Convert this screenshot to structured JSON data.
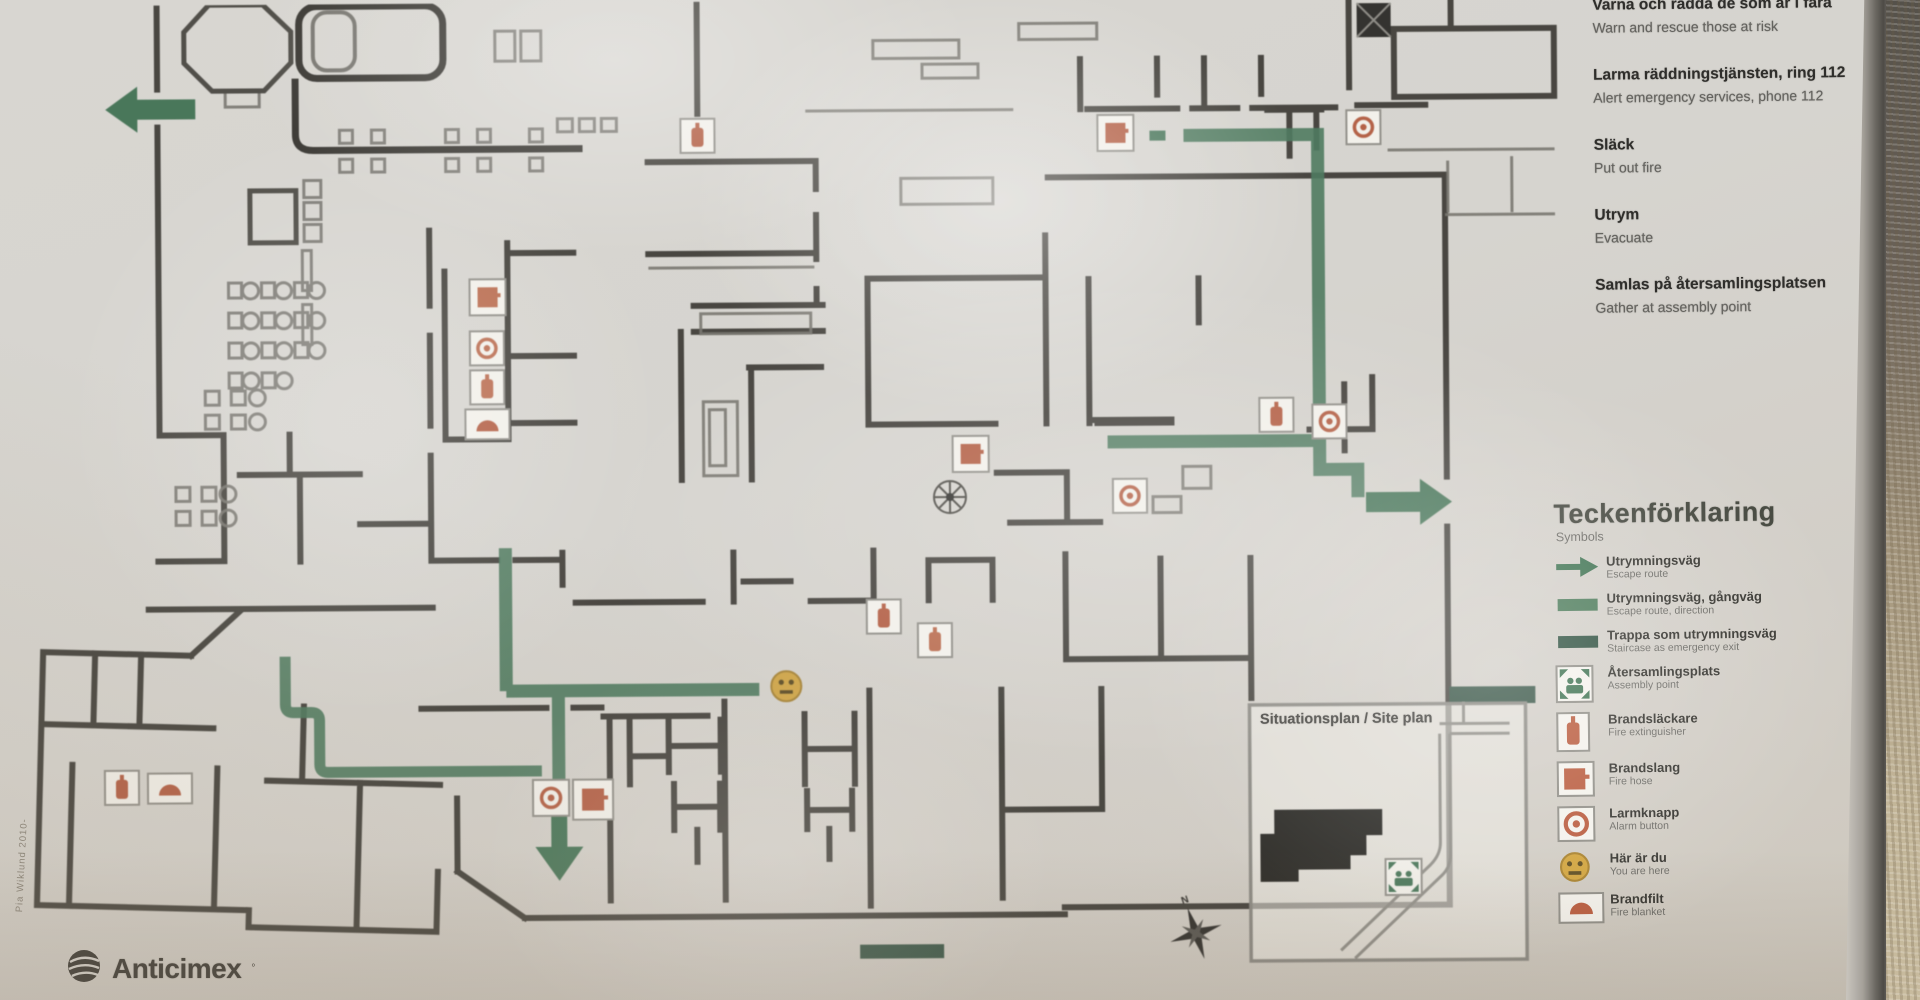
{
  "sign": {
    "instructions": [
      {
        "sv": "Varna och rädda de som är i fara",
        "en": "Warn and rescue those at risk"
      },
      {
        "sv": "Larma räddningstjänsten, ring 112",
        "en": "Alert emergency services, phone 112"
      },
      {
        "sv": "Släck",
        "en": "Put out fire"
      },
      {
        "sv": "Utrym",
        "en": "Evacuate"
      },
      {
        "sv": "Samlas på återsamlingsplatsen",
        "en": "Gather at assembly point"
      }
    ],
    "legend": {
      "title": "Teckenförklaring",
      "subtitle": "Symbols",
      "items": [
        {
          "icon": "escape-route-arrow-icon",
          "sv": "Utrymningsväg",
          "en": "Escape route"
        },
        {
          "icon": "escape-route-walkway-icon",
          "sv": "Utrymningsväg, gångväg",
          "en": "Escape route, direction"
        },
        {
          "icon": "stair-escape-icon",
          "sv": "Trappa som utrymningsväg",
          "en": "Staircase as emergency exit"
        },
        {
          "icon": "assembly-point-icon",
          "sv": "Återsamlingsplats",
          "en": "Assembly point"
        },
        {
          "icon": "fire-extinguisher-icon",
          "sv": "Brandsläckare",
          "en": "Fire extinguisher"
        },
        {
          "icon": "fire-hose-icon",
          "sv": "Brandslang",
          "en": "Fire hose"
        },
        {
          "icon": "alarm-button-icon",
          "sv": "Larmknapp",
          "en": "Alarm button"
        },
        {
          "icon": "you-are-here-icon",
          "sv": "Här är du",
          "en": "You are here"
        },
        {
          "icon": "fire-blanket-icon",
          "sv": "Brandfilt",
          "en": "Fire blanket"
        }
      ]
    },
    "site_plan": {
      "title": "Situationsplan / Site plan"
    },
    "compass": {
      "north_label": "N"
    },
    "brand": {
      "name": "Anticimex"
    },
    "author_note": "Pia Wiklund 2010-",
    "colors": {
      "route_green": "#46785a",
      "stair_green": "#2f5140",
      "symbol_red": "#b95b3d",
      "you_are_here_yellow": "#d2a43c",
      "wall": "#34322d",
      "paper": "#d8d6d1"
    }
  }
}
